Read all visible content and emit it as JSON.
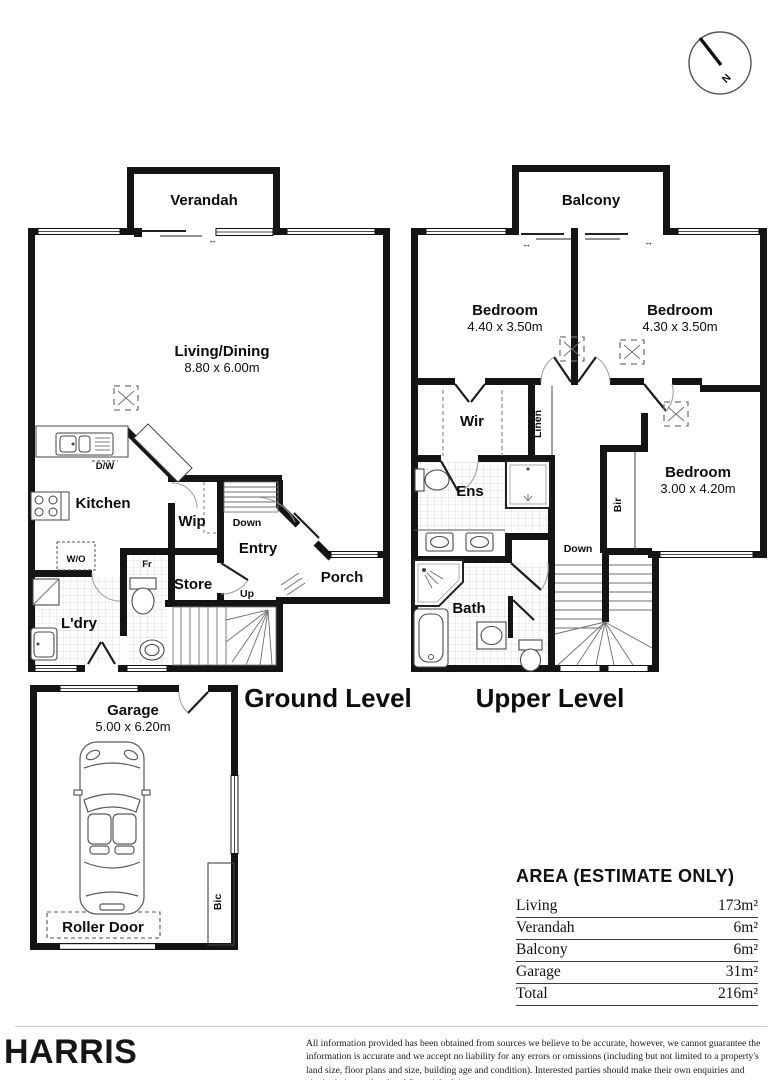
{
  "compass": {
    "north_label": "N"
  },
  "levels": {
    "ground_title": "Ground Level",
    "upper_title": "Upper Level"
  },
  "ground": {
    "verandah": "Verandah",
    "living_name": "Living/Dining",
    "living_dims": "8.80 x 6.00m",
    "kitchen": "Kitchen",
    "dw": "D/W",
    "wip": "Wip",
    "down": "Down",
    "entry": "Entry",
    "porch": "Porch",
    "store": "Store",
    "up": "Up",
    "wo": "W/O",
    "fr": "Fr",
    "ldry": "L'dry"
  },
  "upper": {
    "balcony": "Balcony",
    "bed1_name": "Bedroom",
    "bed1_dims": "4.40 x 3.50m",
    "bed2_name": "Bedroom",
    "bed2_dims": "4.30 x 3.50m",
    "bed3_name": "Bedroom",
    "bed3_dims": "3.00 x 4.20m",
    "wir": "Wir",
    "linen": "Linen",
    "ens": "Ens",
    "bir": "Bir",
    "bath": "Bath",
    "down": "Down"
  },
  "garage": {
    "name": "Garage",
    "dims": "5.00 x 6.20m",
    "roller_door": "Roller Door",
    "bic": "Bic"
  },
  "area_table": {
    "title": "AREA (ESTIMATE ONLY)",
    "rows": [
      {
        "label": "Living",
        "value": "173m²"
      },
      {
        "label": "Verandah",
        "value": "6m²"
      },
      {
        "label": "Balcony",
        "value": "6m²"
      },
      {
        "label": "Garage",
        "value": "31m²"
      },
      {
        "label": "Total",
        "value": "216m²"
      }
    ]
  },
  "footer": {
    "brand": "HARRIS",
    "disclaimer": "All information provided has been obtained from sources we believe to be accurate, however, we cannot guarantee the information is accurate and we accept no liability for any errors or omissions (including but not limited to a property's land size, floor plans and size, building age and condition). Interested parties should make their own enquiries and obtain their own legal and financial advice."
  },
  "colors": {
    "wall": "#141414",
    "tile_line": "#d9d9d9",
    "separator": "#c9c9c9"
  }
}
